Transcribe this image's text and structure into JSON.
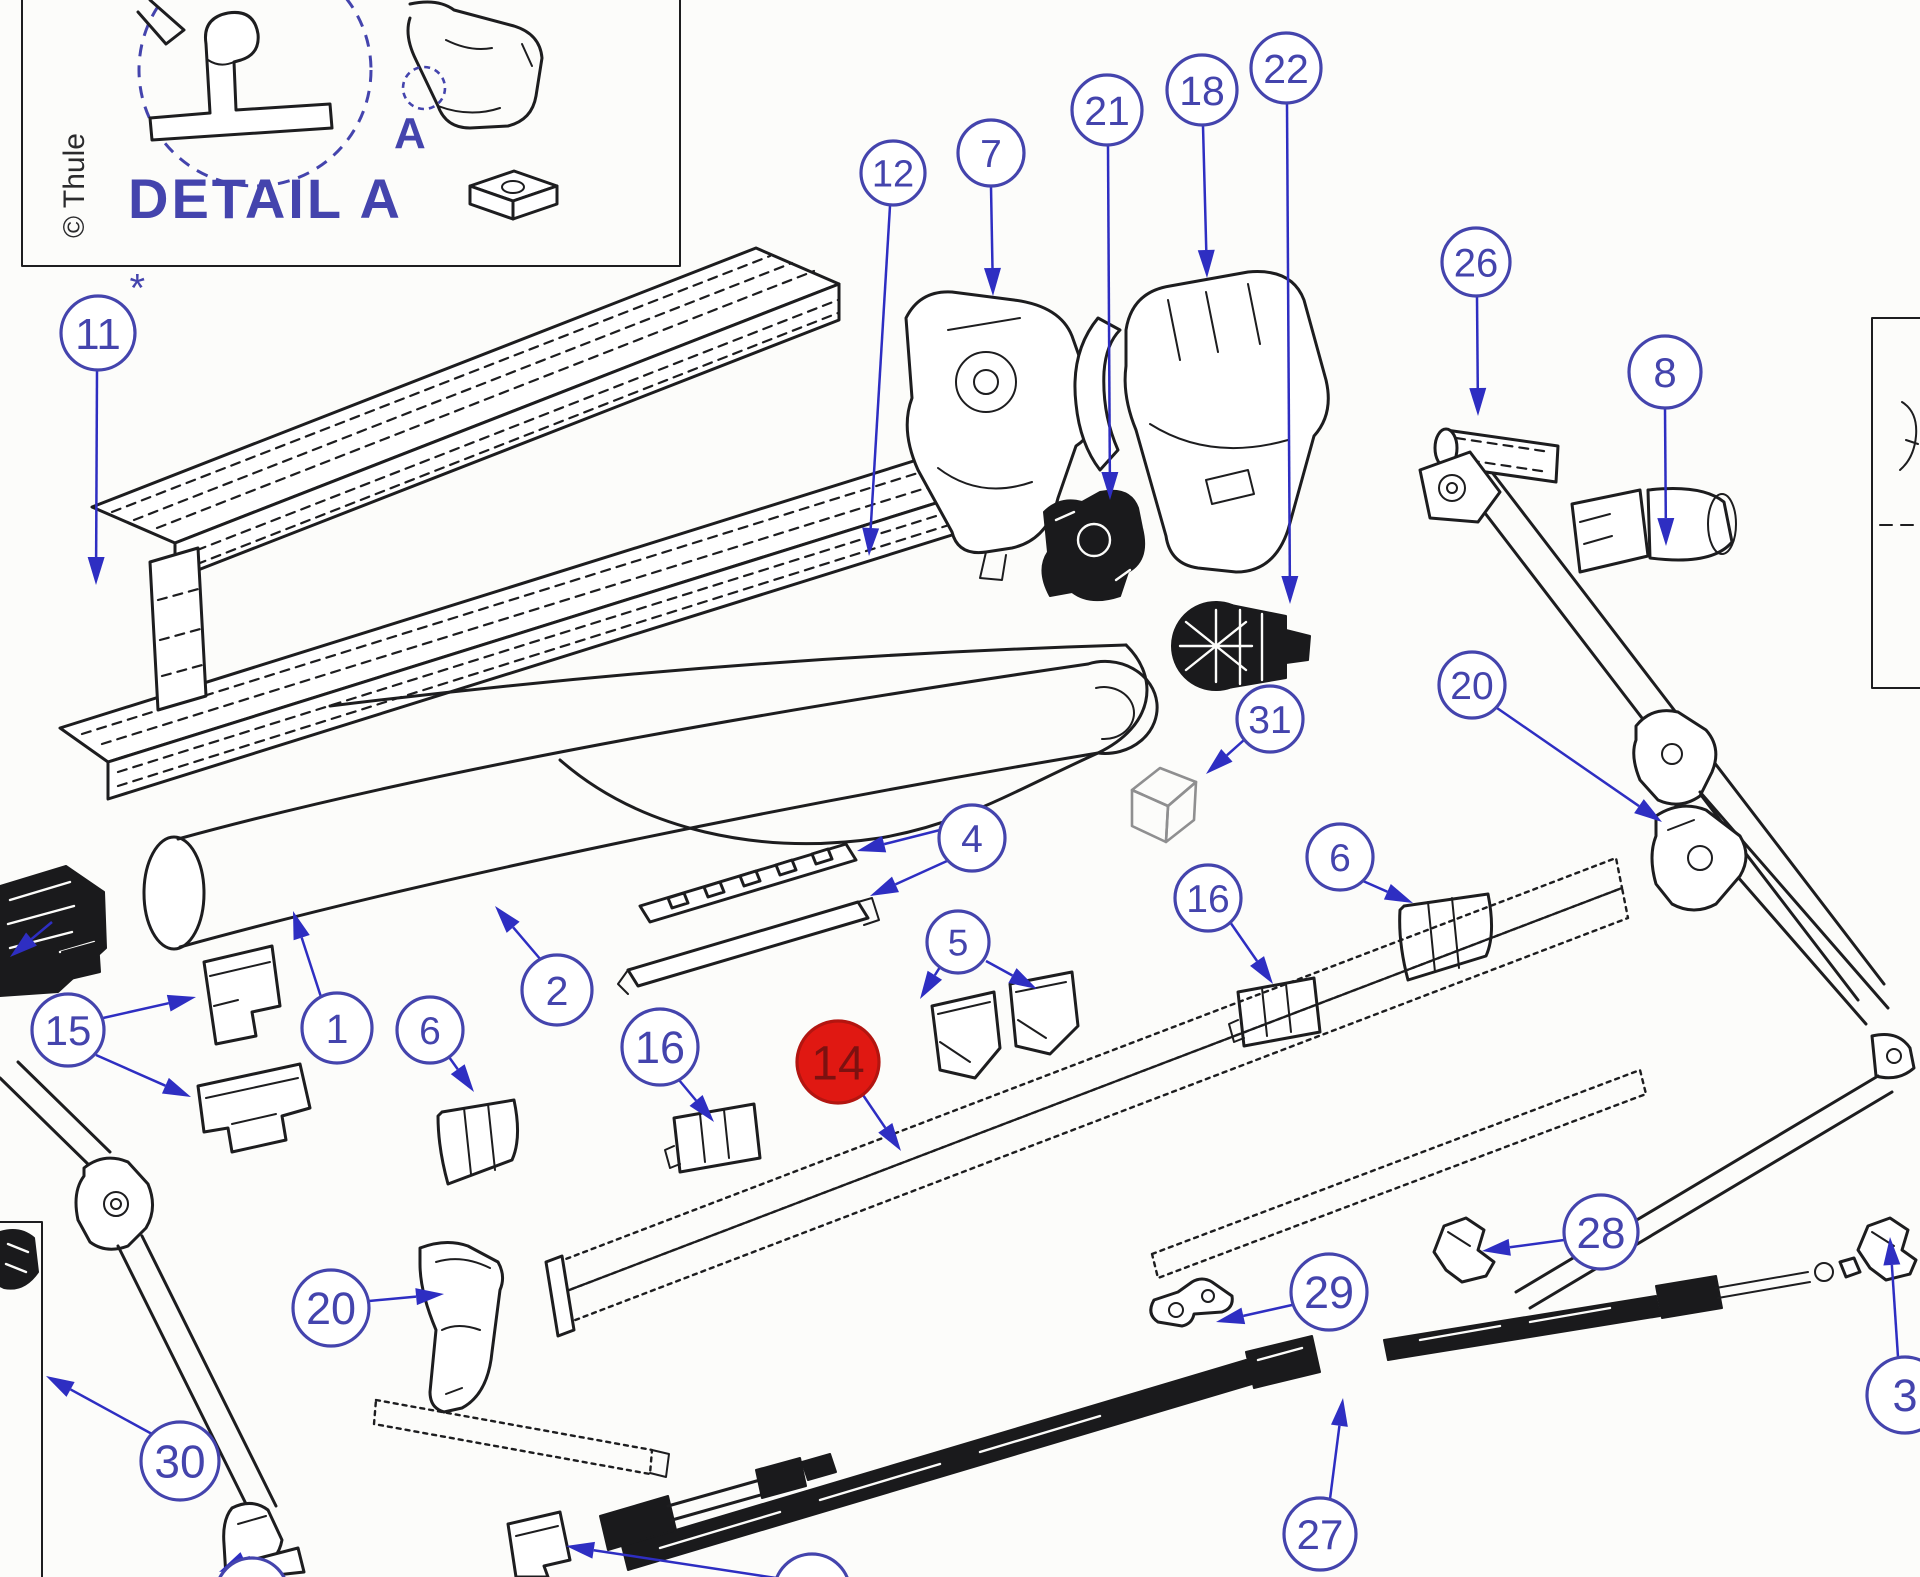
{
  "colors": {
    "ink_blue": "#4444ad",
    "arrow_blue": "#2e2ec2",
    "line_black": "#1d1d1f",
    "highlight_fill": "#e01812",
    "highlight_text": "#7c1110",
    "highlight_stroke": "#b31510",
    "background": "#fcfcfa"
  },
  "detail_box": {
    "copyright": "© Thule",
    "title": "DETAIL A",
    "marker": "A"
  },
  "balloons": [
    {
      "id": "11",
      "label": "11",
      "x": 98,
      "y": 333,
      "r": 37,
      "asterisk": true,
      "leaders": [
        {
          "from": [
            97,
            371
          ],
          "tip": [
            96,
            585
          ]
        }
      ]
    },
    {
      "id": "12",
      "label": "12",
      "x": 893,
      "y": 173,
      "r": 32,
      "leaders": [
        {
          "from": [
            890,
            206
          ],
          "tip": [
            869,
            556
          ]
        }
      ]
    },
    {
      "id": "7",
      "label": "7",
      "x": 991,
      "y": 153,
      "r": 33,
      "leaders": [
        {
          "from": [
            991,
            187
          ],
          "tip": [
            993,
            296
          ]
        }
      ]
    },
    {
      "id": "21",
      "label": "21",
      "x": 1107,
      "y": 110,
      "r": 35,
      "leaders": [
        {
          "from": [
            1108,
            146
          ],
          "tip": [
            1110,
            500
          ]
        }
      ]
    },
    {
      "id": "18",
      "label": "18",
      "x": 1202,
      "y": 90,
      "r": 35,
      "leaders": [
        {
          "from": [
            1203,
            126
          ],
          "tip": [
            1207,
            278
          ]
        }
      ]
    },
    {
      "id": "22",
      "label": "22",
      "x": 1286,
      "y": 68,
      "r": 35,
      "leaders": [
        {
          "from": [
            1287,
            104
          ],
          "tip": [
            1290,
            604
          ]
        }
      ]
    },
    {
      "id": "26",
      "label": "26",
      "x": 1476,
      "y": 262,
      "r": 34,
      "leaders": [
        {
          "from": [
            1477,
            297
          ],
          "tip": [
            1478,
            416
          ]
        }
      ]
    },
    {
      "id": "8",
      "label": "8",
      "x": 1665,
      "y": 372,
      "r": 36,
      "leaders": [
        {
          "from": [
            1665,
            409
          ],
          "tip": [
            1666,
            546
          ]
        }
      ]
    },
    {
      "id": "31",
      "label": "31",
      "x": 1270,
      "y": 719,
      "r": 33,
      "leaders": [
        {
          "from": [
            1244,
            740
          ],
          "tip": [
            1206,
            774
          ]
        }
      ]
    },
    {
      "id": "20R",
      "label": "20",
      "x": 1472,
      "y": 685,
      "r": 33,
      "leaders": [
        {
          "from": [
            1497,
            708
          ],
          "tip": [
            1662,
            822
          ]
        }
      ]
    },
    {
      "id": "4",
      "label": "4",
      "x": 972,
      "y": 838,
      "r": 33,
      "leaders": [
        {
          "from": [
            940,
            830
          ],
          "tip": [
            857,
            851
          ]
        },
        {
          "from": [
            947,
            861
          ],
          "tip": [
            870,
            896
          ]
        }
      ]
    },
    {
      "id": "5",
      "label": "5",
      "x": 958,
      "y": 942,
      "r": 31,
      "leaders": [
        {
          "from": [
            940,
            967
          ],
          "tip": [
            920,
            999
          ]
        },
        {
          "from": [
            986,
            961
          ],
          "tip": [
            1037,
            989
          ]
        }
      ]
    },
    {
      "id": "16R",
      "label": "16",
      "x": 1208,
      "y": 898,
      "r": 33,
      "leaders": [
        {
          "from": [
            1230,
            922
          ],
          "tip": [
            1273,
            984
          ]
        }
      ]
    },
    {
      "id": "6R",
      "label": "6",
      "x": 1340,
      "y": 857,
      "r": 33,
      "leaders": [
        {
          "from": [
            1363,
            881
          ],
          "tip": [
            1413,
            903
          ]
        }
      ]
    },
    {
      "id": "2",
      "label": "2",
      "x": 557,
      "y": 990,
      "r": 35,
      "leaders": [
        {
          "from": [
            541,
            960
          ],
          "tip": [
            495,
            906
          ]
        }
      ]
    },
    {
      "id": "1",
      "label": "1",
      "x": 337,
      "y": 1028,
      "r": 35,
      "leaders": [
        {
          "from": [
            321,
            997
          ],
          "tip": [
            293,
            911
          ]
        }
      ]
    },
    {
      "id": "6L",
      "label": "6",
      "x": 430,
      "y": 1030,
      "r": 33,
      "leaders": [
        {
          "from": [
            449,
            1057
          ],
          "tip": [
            474,
            1092
          ]
        }
      ]
    },
    {
      "id": "15",
      "label": "15",
      "x": 68,
      "y": 1030,
      "r": 36,
      "leaders": [
        {
          "from": [
            103,
            1018
          ],
          "tip": [
            196,
            997
          ]
        },
        {
          "from": [
            96,
            1055
          ],
          "tip": [
            191,
            1097
          ]
        }
      ]
    },
    {
      "id": "16L",
      "label": "16",
      "x": 660,
      "y": 1047,
      "r": 38,
      "leaders": [
        {
          "from": [
            679,
            1080
          ],
          "tip": [
            714,
            1122
          ]
        }
      ]
    },
    {
      "id": "14",
      "label": "14",
      "x": 838,
      "y": 1062,
      "r": 41,
      "style": "highlight",
      "leaders": [
        {
          "from": [
            863,
            1095
          ],
          "tip": [
            901,
            1151
          ]
        }
      ]
    },
    {
      "id": "28",
      "label": "28",
      "x": 1601,
      "y": 1232,
      "r": 37,
      "leaders": [
        {
          "from": [
            1564,
            1240
          ],
          "tip": [
            1482,
            1251
          ]
        }
      ]
    },
    {
      "id": "29",
      "label": "29",
      "x": 1329,
      "y": 1292,
      "r": 38,
      "leaders": [
        {
          "from": [
            1292,
            1305
          ],
          "tip": [
            1216,
            1322
          ]
        }
      ]
    },
    {
      "id": "20L",
      "label": "20",
      "x": 331,
      "y": 1308,
      "r": 38,
      "leaders": [
        {
          "from": [
            369,
            1301
          ],
          "tip": [
            444,
            1294
          ]
        }
      ]
    },
    {
      "id": "30",
      "label": "30",
      "x": 180,
      "y": 1461,
      "r": 39,
      "leaders": [
        {
          "from": [
            152,
            1434
          ],
          "tip": [
            46,
            1376
          ]
        }
      ]
    },
    {
      "id": "27",
      "label": "27",
      "x": 1320,
      "y": 1534,
      "r": 36,
      "leaders": [
        {
          "from": [
            1330,
            1499
          ],
          "tip": [
            1343,
            1398
          ]
        }
      ]
    },
    {
      "id": "3",
      "label": "3",
      "x": 1905,
      "y": 1395,
      "r": 38,
      "leaders": [
        {
          "from": [
            1898,
            1357
          ],
          "tip": [
            1890,
            1237
          ]
        }
      ]
    },
    {
      "id": "cutA",
      "label": "",
      "x": 252,
      "y": 1594,
      "r": 36,
      "leaders": [
        {
          "from": [
            250,
            1557
          ],
          "tip": [
            219,
            1572
          ]
        }
      ]
    },
    {
      "id": "cutB",
      "label": "",
      "x": 812,
      "y": 1592,
      "r": 38,
      "leaders": [
        {
          "from": [
            776,
            1578
          ],
          "tip": [
            566,
            1546
          ]
        }
      ]
    }
  ],
  "stray_arrows": [
    {
      "from": [
        52,
        922
      ],
      "tip": [
        10,
        957
      ]
    }
  ]
}
